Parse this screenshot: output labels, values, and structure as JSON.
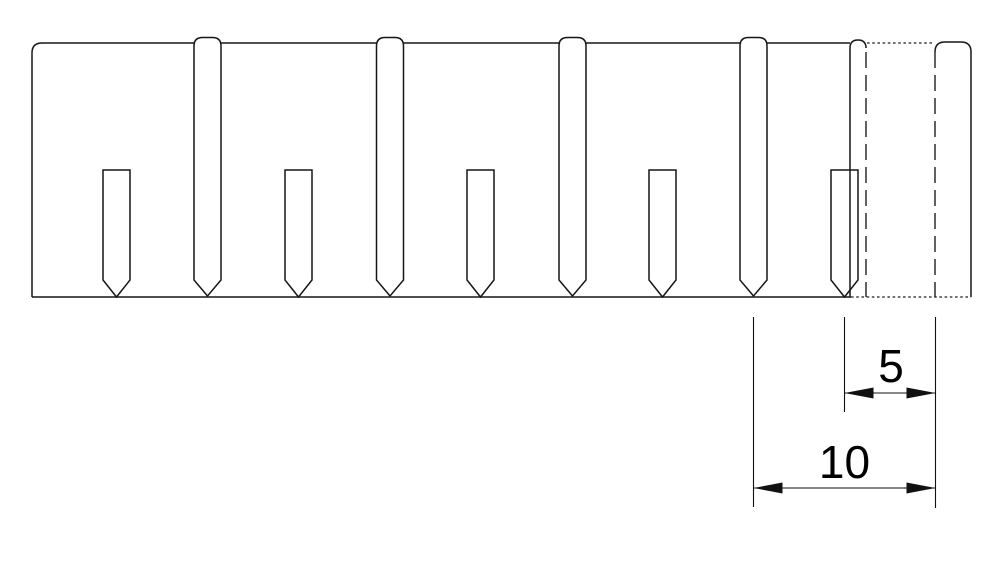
{
  "colors": {
    "background": "#ffffff",
    "line": "#161616",
    "hidden_line": "#1e1e1e",
    "dim_line": "#111111",
    "text": "#000000"
  },
  "drawing": {
    "canvas": {
      "width": 988,
      "height": 571
    },
    "part": {
      "left": 32,
      "top": 43,
      "right": 971,
      "bottom": 297,
      "corner_radius": 10,
      "top_hidden": {
        "x1": 867,
        "x2": 933
      },
      "bottom_solid_end": 851,
      "tab": {
        "left": 935,
        "right": 971,
        "top": 42,
        "radius": 10
      }
    },
    "long_slots": {
      "centers": [
        207.5,
        390,
        572.5,
        753.5
      ],
      "half_width": 13.5,
      "apex": 37.5,
      "shoulder": 46,
      "taper_start": 280,
      "tip": 296
    },
    "short_slots": {
      "centers": [
        116.5,
        298.5,
        480.5,
        662.5,
        844.5
      ],
      "half_width": 13.5,
      "top": 170,
      "taper_start": 280,
      "tip": 297
    },
    "end_slot": {
      "left": 850,
      "right": 866,
      "apex": 40,
      "shoulder": 48,
      "bottom": 297
    },
    "hidden_verticals": [
      {
        "x": 866,
        "y1": 52,
        "y2": 297
      },
      {
        "x": 935,
        "y1": 52,
        "y2": 297
      }
    ],
    "styles": {
      "outline_width": 1.5,
      "thin_width": 1.1,
      "hidden_width": 1.4,
      "phantom_width": 1.2,
      "hidden_dash": "16 7",
      "phantom_dash": "2.6 2.6"
    },
    "dimensions": {
      "font_size": 46,
      "arrow": {
        "length": 29,
        "half_width": 5.5
      },
      "extension_lines": [
        {
          "x": 753.5,
          "y1": 317,
          "y2": 507
        },
        {
          "x": 844.5,
          "y1": 317,
          "y2": 412
        },
        {
          "x": 935.5,
          "y1": 317,
          "y2": 508
        }
      ],
      "items": [
        {
          "label": "5",
          "x1": 844.5,
          "x2": 935.5,
          "y": 393,
          "label_x": 891,
          "label_y": 382
        },
        {
          "label": "10",
          "x1": 753.5,
          "x2": 935.5,
          "y": 488,
          "label_x": 844.5,
          "label_y": 478
        }
      ]
    }
  }
}
